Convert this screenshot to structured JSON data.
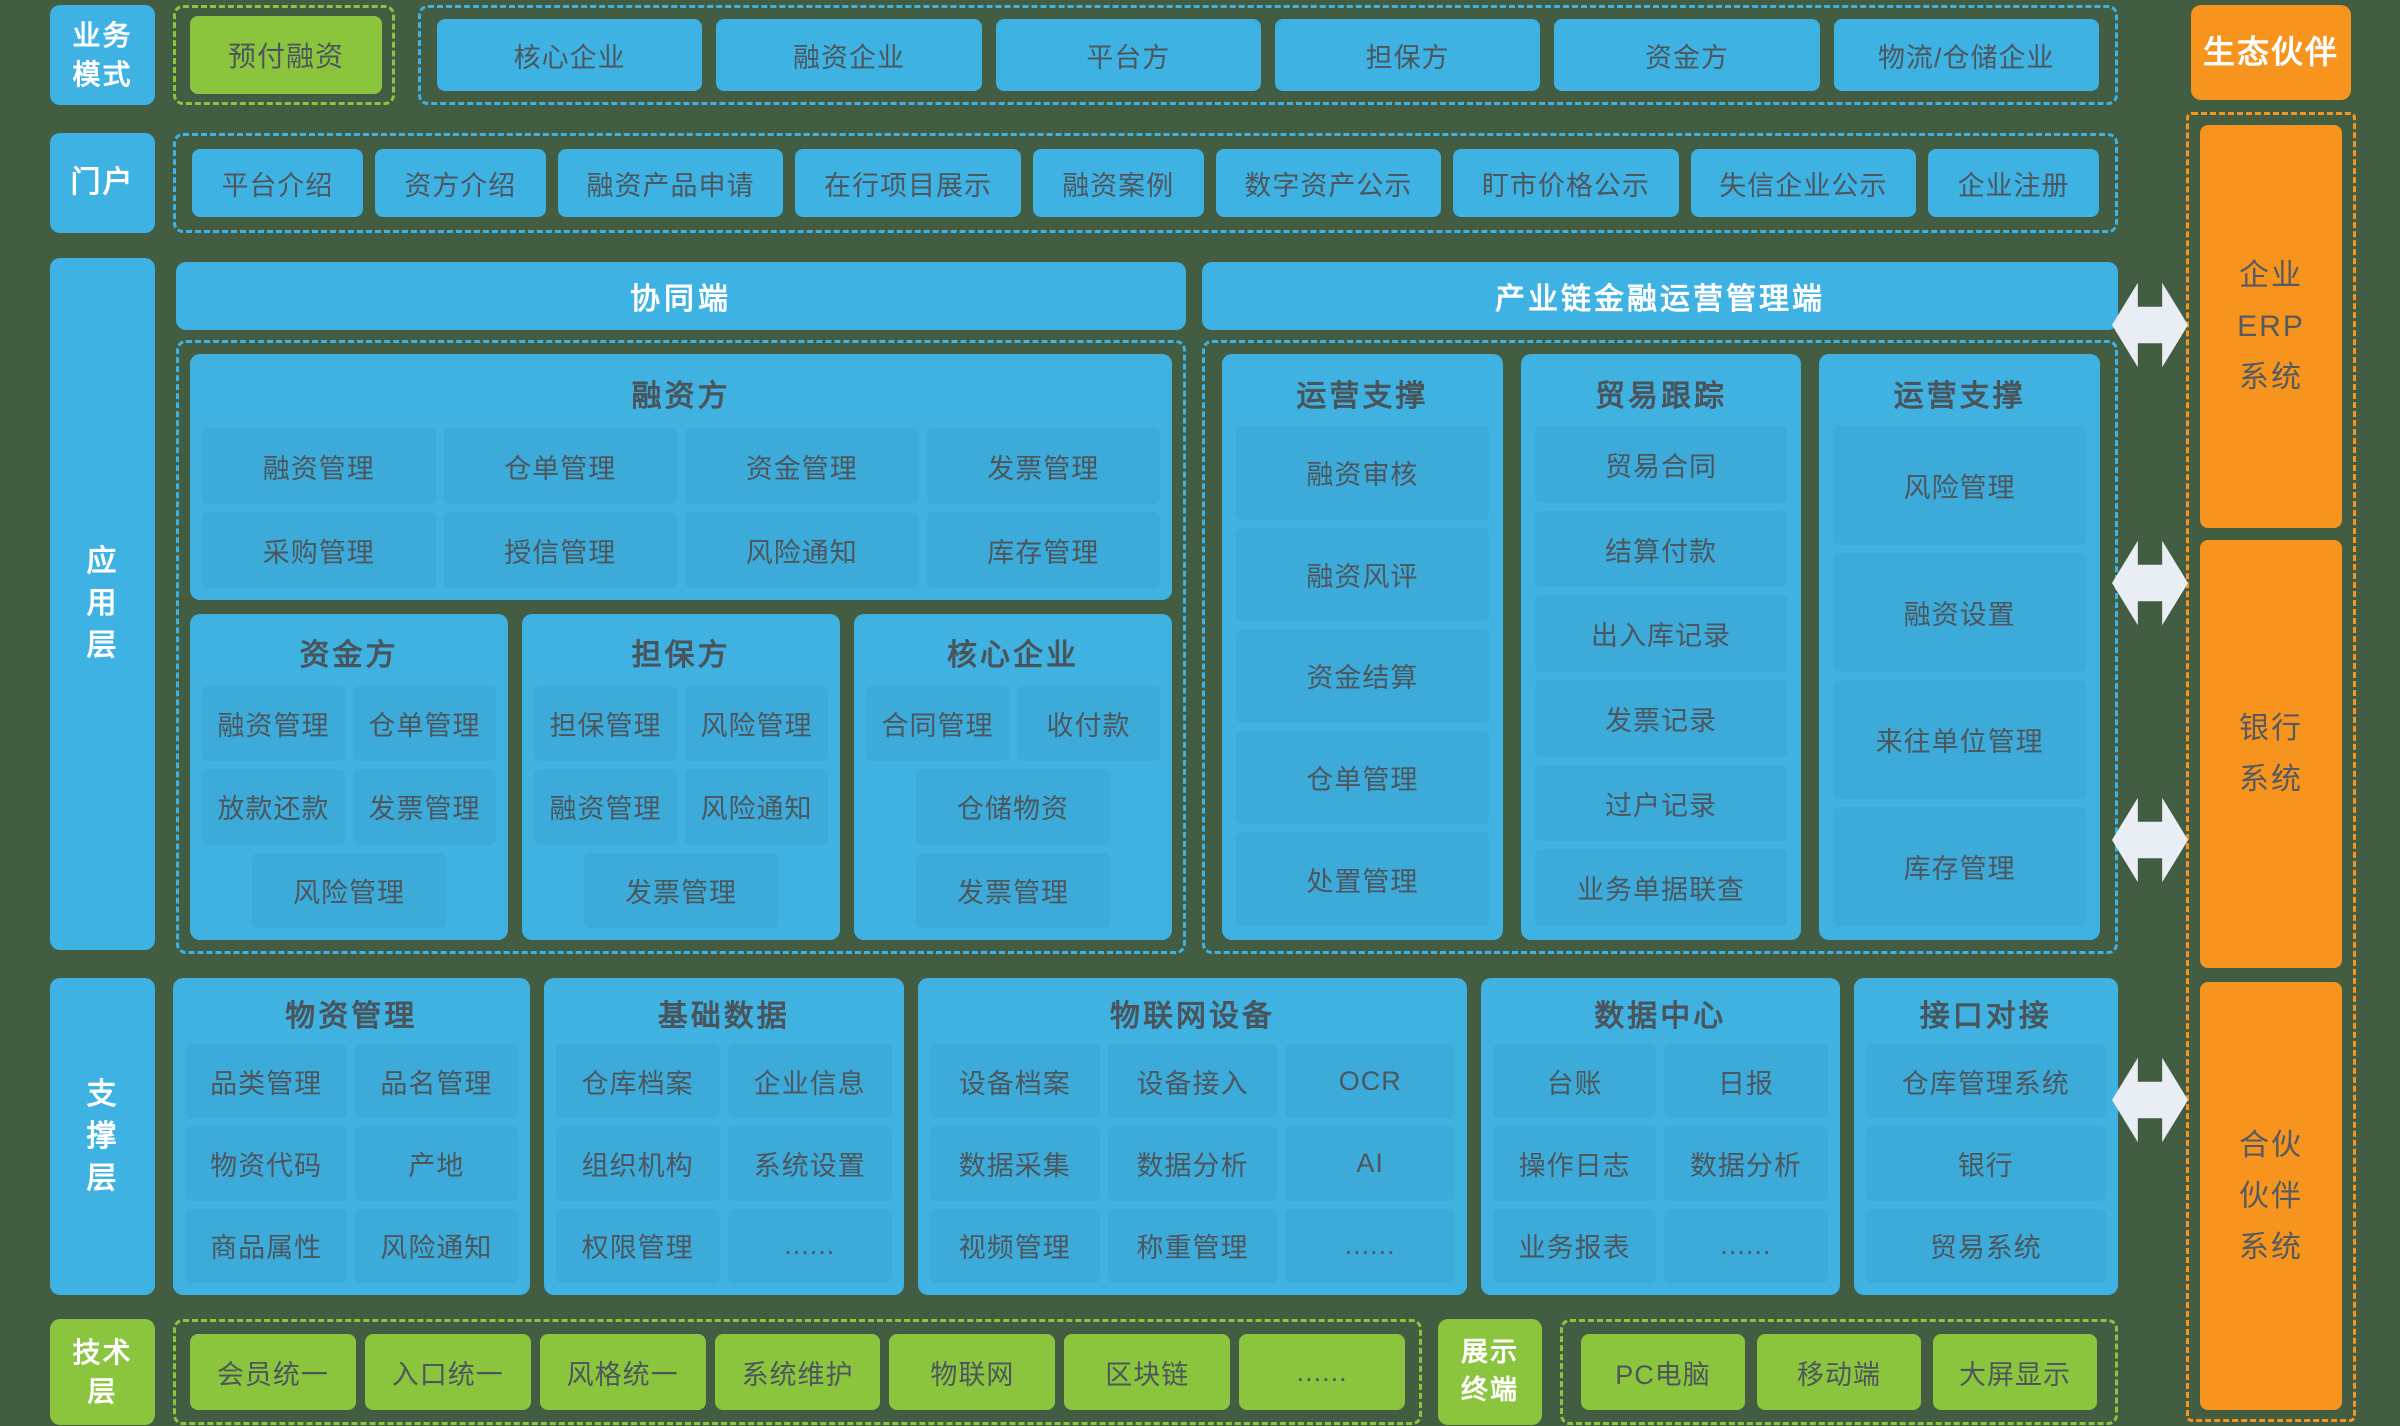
{
  "colors": {
    "background": "#425D41",
    "blue": "#3EB2E3",
    "green": "#8BC53E",
    "orange": "#F7941D",
    "box_text": "#4D565C",
    "arrow": "#E8EEF4"
  },
  "labels": {
    "business_mode": "业务\n模式",
    "portal": "门户",
    "application": "应\n用\n层",
    "support": "支\n撑\n层",
    "technology": "技术\n层",
    "display_terminal": "展示\n终端",
    "eco_partner": "生态伙伴"
  },
  "business_mode": {
    "highlight": "预付融资",
    "parties": [
      "核心企业",
      "融资企业",
      "平台方",
      "担保方",
      "资金方",
      "物流/仓储企业"
    ]
  },
  "portal": {
    "items": [
      "平台介绍",
      "资方介绍",
      "融资产品申请",
      "在行项目展示",
      "融资案例",
      "数字资产公示",
      "盯市价格公示",
      "失信企业公示",
      "企业注册"
    ]
  },
  "collab": {
    "title": "协同端",
    "financier": {
      "title": "融资方",
      "items": [
        "融资管理",
        "仓单管理",
        "资金管理",
        "发票管理",
        "采购管理",
        "授信管理",
        "风险通知",
        "库存管理"
      ]
    },
    "funder": {
      "title": "资金方",
      "items": [
        "融资管理",
        "仓单管理",
        "放款还款",
        "发票管理",
        "风险管理"
      ]
    },
    "guarantor": {
      "title": "担保方",
      "items": [
        "担保管理",
        "风险管理",
        "融资管理",
        "风险通知",
        "发票管理"
      ]
    },
    "core": {
      "title": "核心企业",
      "items": [
        "合同管理",
        "收付款",
        "仓储物资",
        "发票管理"
      ]
    }
  },
  "ops": {
    "title": "产业链金融运营管理端",
    "col1": {
      "title": "运营支撑",
      "items": [
        "融资审核",
        "融资风评",
        "资金结算",
        "仓单管理",
        "处置管理"
      ]
    },
    "col2": {
      "title": "贸易跟踪",
      "items": [
        "贸易合同",
        "结算付款",
        "出入库记录",
        "发票记录",
        "过户记录",
        "业务单据联查"
      ]
    },
    "col3": {
      "title": "运营支撑",
      "items": [
        "风险管理",
        "融资设置",
        "来往单位管理",
        "库存管理"
      ]
    }
  },
  "support": {
    "groups": [
      {
        "title": "物资管理",
        "items": [
          "品类管理",
          "品名管理",
          "物资代码",
          "产地",
          "商品属性",
          "风险通知"
        ]
      },
      {
        "title": "基础数据",
        "items": [
          "仓库档案",
          "企业信息",
          "组织机构",
          "系统设置",
          "权限管理",
          "......"
        ]
      },
      {
        "title": "物联网设备",
        "items": [
          "设备档案",
          "设备接入",
          "OCR",
          "数据采集",
          "数据分析",
          "AI",
          "视频管理",
          "称重管理",
          "......"
        ]
      },
      {
        "title": "数据中心",
        "items": [
          "台账",
          "日报",
          "操作日志",
          "数据分析",
          "业务报表",
          "......"
        ]
      },
      {
        "title": "接口对接",
        "items": [
          "仓库管理系统",
          "银行",
          "贸易系统"
        ]
      }
    ]
  },
  "tech": {
    "items": [
      "会员统一",
      "入口统一",
      "风格统一",
      "系统维护",
      "物联网",
      "区块链",
      "......"
    ]
  },
  "display": {
    "items": [
      "PC电脑",
      "移动端",
      "大屏显示"
    ]
  },
  "eco": {
    "systems": [
      "企业\nERP\n系统",
      "银行\n系统",
      "合伙\n伙伴\n系统"
    ]
  }
}
